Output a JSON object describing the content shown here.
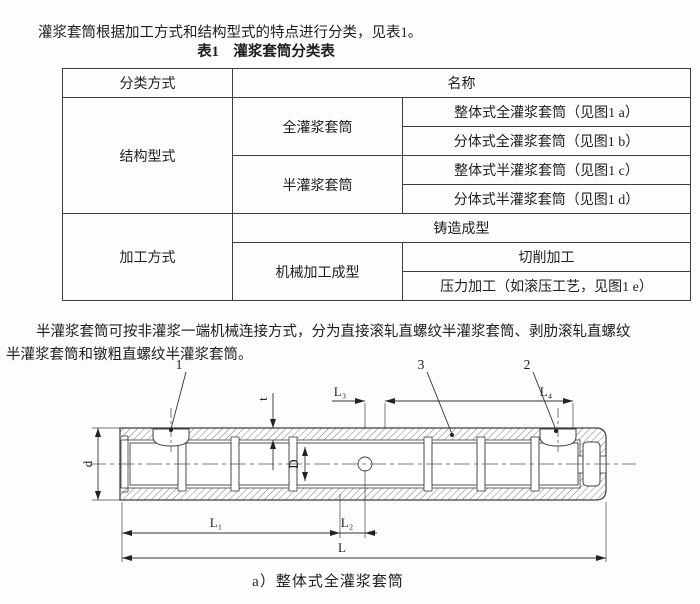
{
  "page": {
    "intro": "灌浆套筒根据加工方式和结构型式的特点进行分类，见表1。",
    "table_caption": "表1　灌浆套筒分类表",
    "para2_line1": "半灌浆套筒可按非灌浆一端机械连接方式，分为直接滚轧直螺纹半灌浆套筒、剥肋滚轧直螺纹",
    "para2_line2": "半灌浆套筒和镦粗直螺纹半灌浆套筒。"
  },
  "table": {
    "header": {
      "classification": "分类方式",
      "name": "名称"
    },
    "structure": {
      "label": "结构型式",
      "full": "全灌浆套筒",
      "full_integral": "整体式全灌浆套筒（见图1 a）",
      "full_split": "分体式全灌浆套筒（见图1 b）",
      "half": "半灌浆套筒",
      "half_integral": "整体式半灌浆套筒（见图1 c）",
      "half_split": "分体式半灌浆套筒（见图1 d）"
    },
    "process": {
      "label": "加工方式",
      "casting": "铸造成型",
      "machining": "机械加工成型",
      "cutting": "切削加工",
      "pressing": "压力加工（如滚压工艺，见图1 e）"
    }
  },
  "figure": {
    "caption": "a）整体式全灌浆套筒",
    "callout_1": "1",
    "callout_2": "2",
    "callout_3": "3",
    "dim_d": "d",
    "dim_D": "D",
    "dim_t": "t",
    "dim_L": "L",
    "dim_L1": "L₁",
    "dim_L2": "L₂",
    "dim_L3": "L₃",
    "dim_L4": "L₄"
  },
  "colors": {
    "line": "#3f3f3f",
    "text": "#1e1e1e",
    "background": "#fdfdfd"
  }
}
